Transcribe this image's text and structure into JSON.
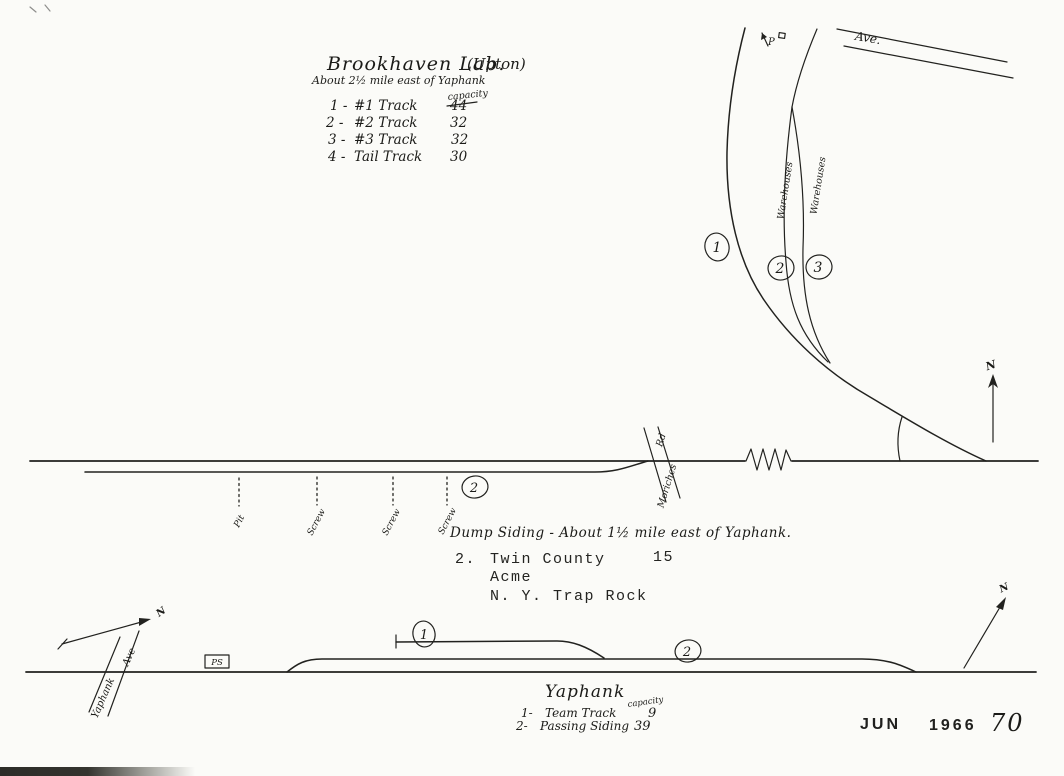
{
  "drawing": {
    "brookhaven": {
      "title": "Brookhaven Lab.",
      "title_suffix": "(Upton)",
      "subtitle": "About 2½ mile east of Yaphank",
      "capacity_header": "capacity",
      "tracks": [
        {
          "num": "1 -",
          "name": "#1 Track",
          "capacity": "44"
        },
        {
          "num": "2 -",
          "name": "#2 Track",
          "capacity": "32"
        },
        {
          "num": "3 -",
          "name": "#3 Track",
          "capacity": "32"
        },
        {
          "num": "4 -",
          "name": "Tail Track",
          "capacity": "30"
        }
      ]
    },
    "upton_yard": {
      "badge_1": "1",
      "badge_2": "2",
      "badge_3": "3",
      "warehouses_1": "Warehouses",
      "warehouses_2": "Warehouses",
      "ave_label": "Ave.",
      "pole_marker": "P"
    },
    "dump_siding": {
      "badge": "2",
      "spots": [
        "Pit",
        "Screw",
        "Screw",
        "Screw"
      ],
      "caption": "Dump Siding - About 1½ mile east of Yaphank.",
      "road_name": "Moriches",
      "road_suffix": "Rd"
    },
    "typed_note": {
      "index": "2.",
      "company_1": "Twin County",
      "capacity": "15",
      "company_2": "Acme",
      "company_3": "N. Y. Trap Rock"
    },
    "yaphank": {
      "badge_1": "1",
      "badge_2": "2",
      "road_name": "Yaphank",
      "road_suffix": "Ave",
      "station_label": "PS",
      "title": "Yaphank",
      "capacity_header": "capacity",
      "tracks": [
        {
          "num": "1-",
          "name": "Team Track",
          "capacity": "9"
        },
        {
          "num": "2-",
          "name": "Passing Siding",
          "capacity": "39"
        }
      ]
    },
    "compass_north": "N",
    "stamp": {
      "month": "JUN",
      "year": "1966",
      "number": "70"
    }
  }
}
